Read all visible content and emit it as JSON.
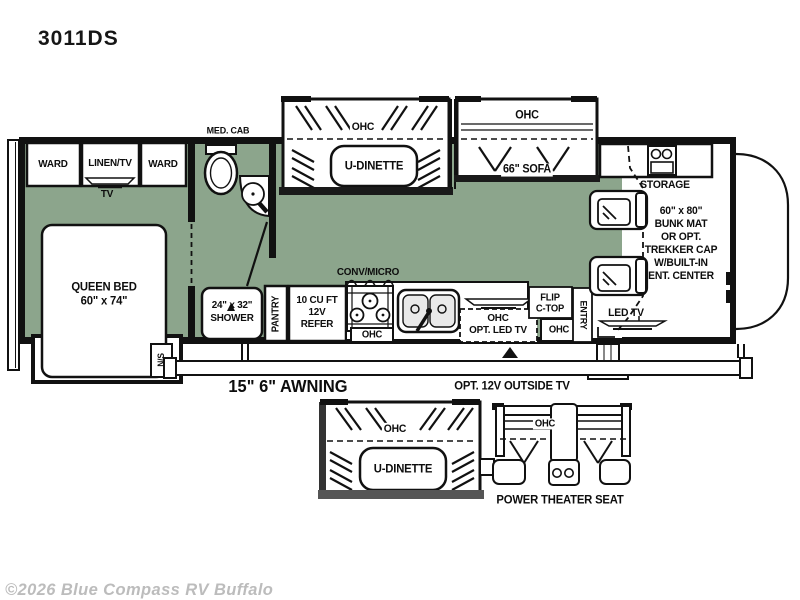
{
  "title": "3011DS",
  "watermark": "©2026 Blue Compass RV Buffalo",
  "colors": {
    "floor": "#8CA58C",
    "line": "#111111"
  },
  "bedroom": {
    "ward_left": "WARD",
    "linen_tv": "LINEN/TV",
    "ward_right": "WARD",
    "tv": "TV",
    "bed_lines": [
      "QUEEN BED",
      "60\" x 74\""
    ],
    "nightstand": "N/S"
  },
  "bathroom": {
    "med_cab": "MED. CAB",
    "shower_lines": [
      "24\" x 32\"",
      "SHOWER"
    ]
  },
  "galley": {
    "pantry": "PANTRY",
    "refer_lines": [
      "10 CU FT",
      "12V",
      "REFER"
    ],
    "conv_micro": "CONV/MICRO",
    "range_ohc": "OHC",
    "sink_ohc_lines": [
      "OHC",
      "OPT. LED TV"
    ],
    "flip_lines": [
      "FLIP",
      "C-TOP"
    ],
    "entry": "ENTRY",
    "entry_ohc": "OHC"
  },
  "dinette_slide": {
    "ohc": "OHC",
    "label": "U-DINETTE"
  },
  "sofa_slide": {
    "ohc": "OHC",
    "label": "66\" SOFA"
  },
  "front": {
    "storage": "STORAGE",
    "bunk_lines": [
      "60\" x 80\"",
      "BUNK MAT",
      "OR OPT.",
      "TREKKER CAP",
      "W/BUILT-IN",
      "ENT. CENTER"
    ],
    "led_tv": "LED TV"
  },
  "exterior": {
    "awning": "15\" 6\" AWNING",
    "outside_tv": "OPT. 12V OUTSIDE TV"
  },
  "options": {
    "dinette_ohc": "OHC",
    "dinette_label": "U-DINETTE",
    "theater_ohc": "OHC",
    "theater_label": "POWER THEATER SEAT"
  }
}
